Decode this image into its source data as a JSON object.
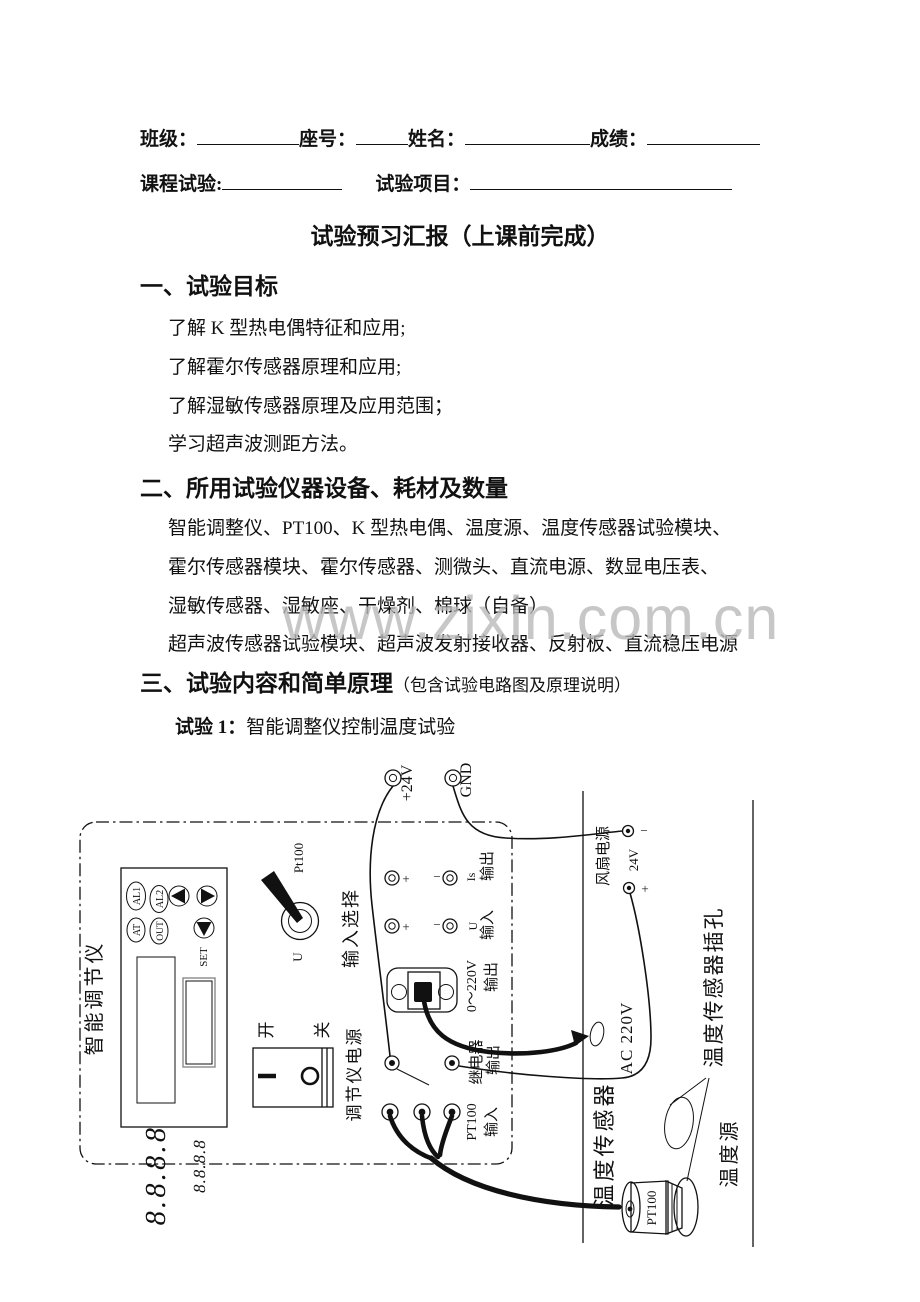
{
  "header": {
    "class_label": "班级：",
    "seat_label": "座号：",
    "name_label": "姓名：",
    "score_label": "成绩：",
    "course_label": "课程试验:",
    "project_label": "试验项目：",
    "title": "试验预习汇报（上课前完成）"
  },
  "watermark": "www.zixin.com.cn",
  "section1": {
    "heading": "一、试验目标",
    "goals": [
      "了解 K 型热电偶特征和应用;",
      "了解霍尔传感器原理和应用;",
      "了解湿敏传感器原理及应用范围；",
      "学习超声波测距方法。"
    ]
  },
  "section2": {
    "heading": "二、所用试验仪器设备、耗材及数量",
    "equipment": [
      "智能调整仪、PT100、K 型热电偶、温度源、温度传感器试验模块、",
      "霍尔传感器模块、霍尔传感器、测微头、直流电源、数显电压表、",
      "湿敏传感器、湿敏座、干燥剂、棉球（自备）",
      "超声波传感器试验模块、超声波发射接收器、反射板、直流稳压电源"
    ]
  },
  "section3": {
    "heading": "三、试验内容和简单原理",
    "note": "（包含试验电路图及原理说明）",
    "exp1_label": "试验 1：",
    "exp1_title": "智能调整仪控制温度试验"
  },
  "diagram": {
    "terminal_24v": "+24V",
    "terminal_gnd": "GND",
    "regulator_name": "智能调节仪",
    "btn_al1": "AL1",
    "btn_al2": "AL2",
    "btn_at": "AT",
    "btn_out": "OUT",
    "btn_set": "SET",
    "display_main": "8.8.8.8",
    "display_sub": "8.8.8.8",
    "sw_pos_pt100": "Pt100",
    "sw_pos_u": "U",
    "input_select": "输入选择",
    "is_label": "Is",
    "u_label": "U",
    "out_label": "输出",
    "in_label": "输入",
    "v220_label": "0～220V",
    "relay_label": "继电器",
    "pt100_in_label": "PT100",
    "power_on": "开",
    "power_off": "关",
    "regulator_power": "调节仪电源",
    "fan_power": "风扇电源",
    "v24_label": "24V",
    "plus": "+",
    "minus": "−",
    "ac220": "AC 220V",
    "temp_sensor": "温度传感器",
    "sensor_jack": "温度传感器插孔",
    "temp_source": "温度源",
    "pt100_probe": "PT100"
  }
}
